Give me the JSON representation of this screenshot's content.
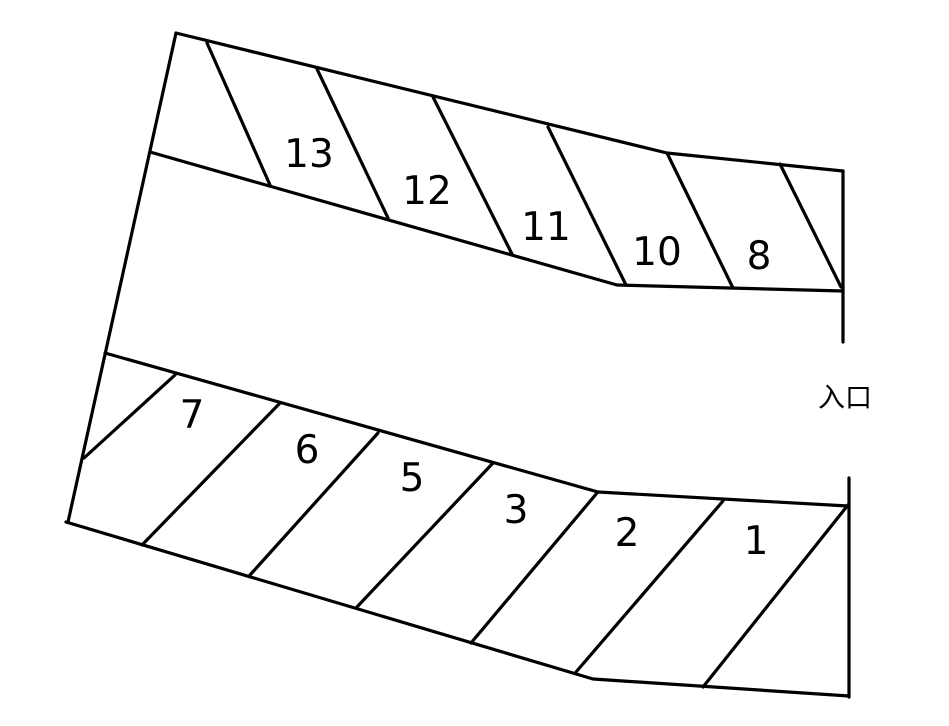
{
  "diagram": {
    "type": "parking-lot-map",
    "colors": {
      "background": "#ffffff",
      "line": "#000000",
      "text": "#000000"
    },
    "entrance": {
      "label": "入口"
    },
    "top_row_spaces": [
      {
        "label": "13"
      },
      {
        "label": "12"
      },
      {
        "label": "11"
      },
      {
        "label": "10"
      },
      {
        "label": "8"
      }
    ],
    "bottom_row_spaces": [
      {
        "label": "7"
      },
      {
        "label": "6"
      },
      {
        "label": "5"
      },
      {
        "label": "3"
      },
      {
        "label": "2"
      },
      {
        "label": "1"
      }
    ]
  }
}
